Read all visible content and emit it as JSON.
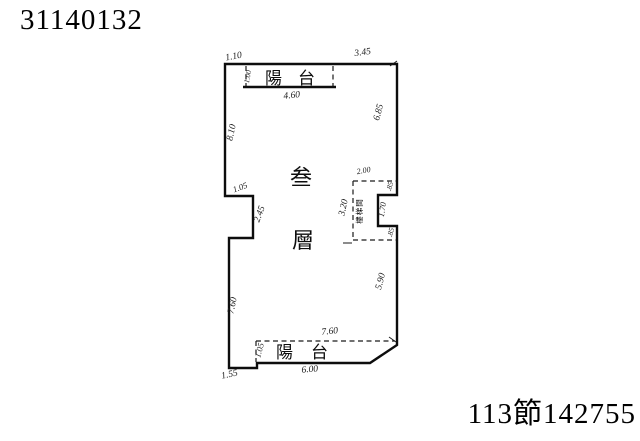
{
  "corner_marks": {
    "top_left": "31140132",
    "bottom_right": "113節142755"
  },
  "floor_plan": {
    "floor_label": {
      "char1": "叁",
      "char2": "層"
    },
    "top_balcony": {
      "name": "陽台",
      "width": "4.60",
      "depth": "1.00"
    },
    "bottom_balcony": {
      "name": "陽台",
      "width": "6.00",
      "span": "7.60",
      "side": "1.05"
    },
    "stairwell": {
      "name": "樓梯間",
      "width": "2.00",
      "height": "3.20",
      "seg_top": ".85",
      "seg_mid": "1.70",
      "seg_bottom": ".85"
    },
    "dims": {
      "top_left": "1.10",
      "top_right": "3.45",
      "left_upper": "8.10",
      "notch_step": "1.05",
      "notch_side": "2.45",
      "left_lower": "7.60",
      "right_upper": "6.85",
      "right_lower": "5.90",
      "bottom_left_seg": "1.55"
    }
  }
}
